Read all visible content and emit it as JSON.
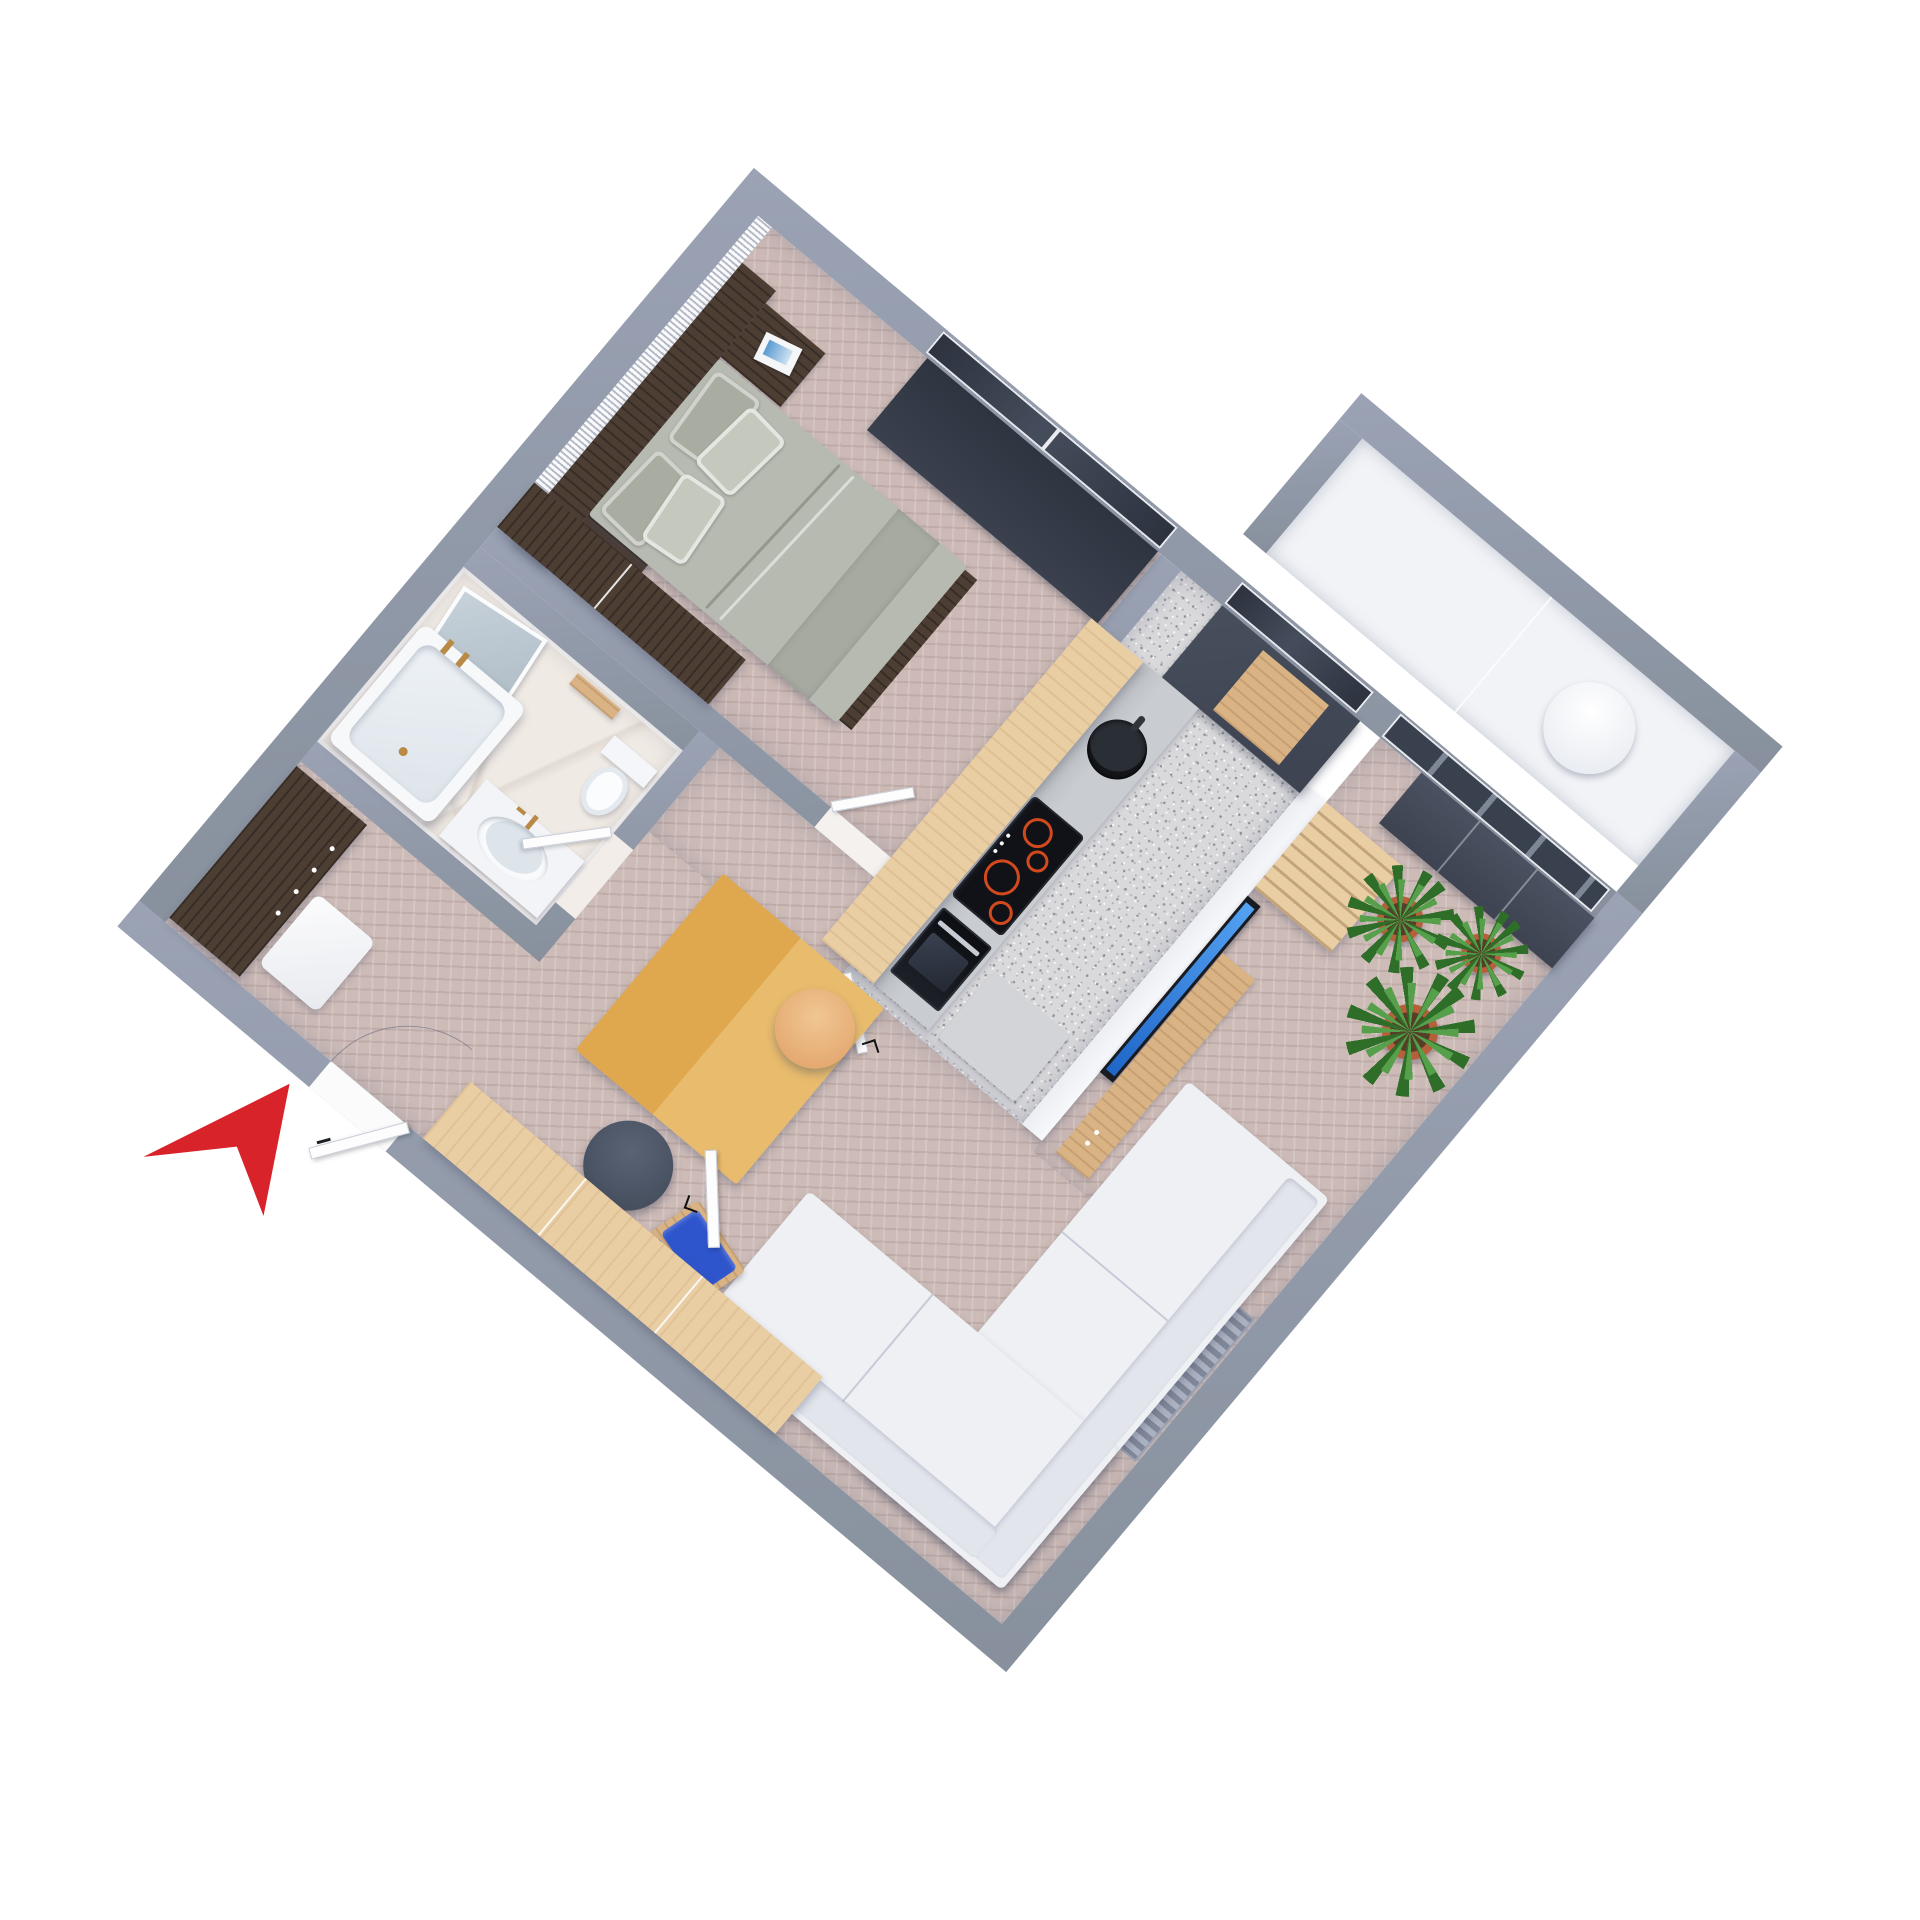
{
  "scene": {
    "title": "Axonometric 3D floor plan of a one-bedroom apartment",
    "background": "#ffffff",
    "rotation_deg": 40
  },
  "palette": {
    "wall": "#87909c",
    "wallEdge": "#9aa2b4",
    "floorBedroom": "#cdbab6",
    "floorLiving": "#cdbbb7",
    "floorKitchen": "#d9d9db",
    "floorMarble": "#f0eae4",
    "balconyFloor": "#f1f3f7",
    "stripe": "#b6bbc8",
    "woodDark": "#4d3e34",
    "woodLight": "#e9cda3",
    "woodMid": "#d9b384",
    "counter": "#c9ccd0",
    "cabinetGray": "#9ba1a8",
    "darkCab": "#3d4350",
    "glassDark": "#323945",
    "tvBlue": "#2f7de0",
    "sofa": "#eef0f4",
    "sofaShade": "#e2e5ec",
    "tableWoodA": "#dfa74e",
    "tableWoodB": "#e9bc6d",
    "armchair": "#2f55cc",
    "pouf": "#47505f",
    "stool": "#e5aa72",
    "plantGreenA": "#2e6e28",
    "plantGreenB": "#57a04b",
    "pot": "#b5603a",
    "soil": "#573e28",
    "brass": "#b98a45",
    "ringRed": "#d2491e",
    "blind": "#3a404d",
    "bedGray": "#b7bab1",
    "pillowA": "#a9ada1",
    "pillowB": "#c4c8bd",
    "arrow": "#d8232a"
  },
  "rooms": {
    "bedroom": {
      "name": "Bedroom",
      "floor": "herringbone parquet",
      "items": [
        "double bed with grey bedding",
        "four pillows",
        "dark wood headboard panel",
        "nightstand with magazines",
        "built-in dark wood wardrobe",
        "slatted accent wall",
        "window with dark roller blind"
      ]
    },
    "bathroom": {
      "name": "Bathroom",
      "floor": "white marble",
      "items": [
        "bathtub with brass taps",
        "oval washbasin with brass faucet",
        "vanity counter",
        "leaning mirror",
        "toilet",
        "wooden wall shelf",
        "brass towel hooks"
      ]
    },
    "hallway": {
      "name": "Hallway",
      "floor": "herringbone parquet",
      "items": [
        "dark wood wardrobe with handles",
        "white bench",
        "entrance door with swing arc"
      ]
    },
    "kitchen": {
      "name": "Kitchen",
      "floor": "grey terrazzo",
      "items": [
        "light wood overhead cabinet slab",
        "grey base cabinet run",
        "round black sink",
        "induction cooktop with four red rings",
        "built-in oven",
        "tall dark cabinet column",
        "wood niche box",
        "window to balcony",
        "grey floor mat",
        "door to hallway"
      ]
    },
    "living_room": {
      "name": "Living room",
      "floor": "herringbone parquet",
      "items": [
        "white L-shaped corner sofa",
        "two-tone wooden coffee table",
        "wall-mounted TV with blue screen",
        "wood media bench",
        "tall wood shelving unit",
        "dark sideboard",
        "three potted plants",
        "blue armchair with wood frame",
        "dark grey round pouf",
        "round tan stool",
        "wall radiator",
        "long light wood wardrobe",
        "sliding glass doors to balcony",
        "open white door"
      ]
    },
    "balcony": {
      "name": "Balcony",
      "floor": "white concrete",
      "items": [
        "round white table"
      ]
    }
  },
  "marker": {
    "name": "entrance arrow",
    "color": "#d8232a",
    "points_to": "apartment entrance door"
  }
}
